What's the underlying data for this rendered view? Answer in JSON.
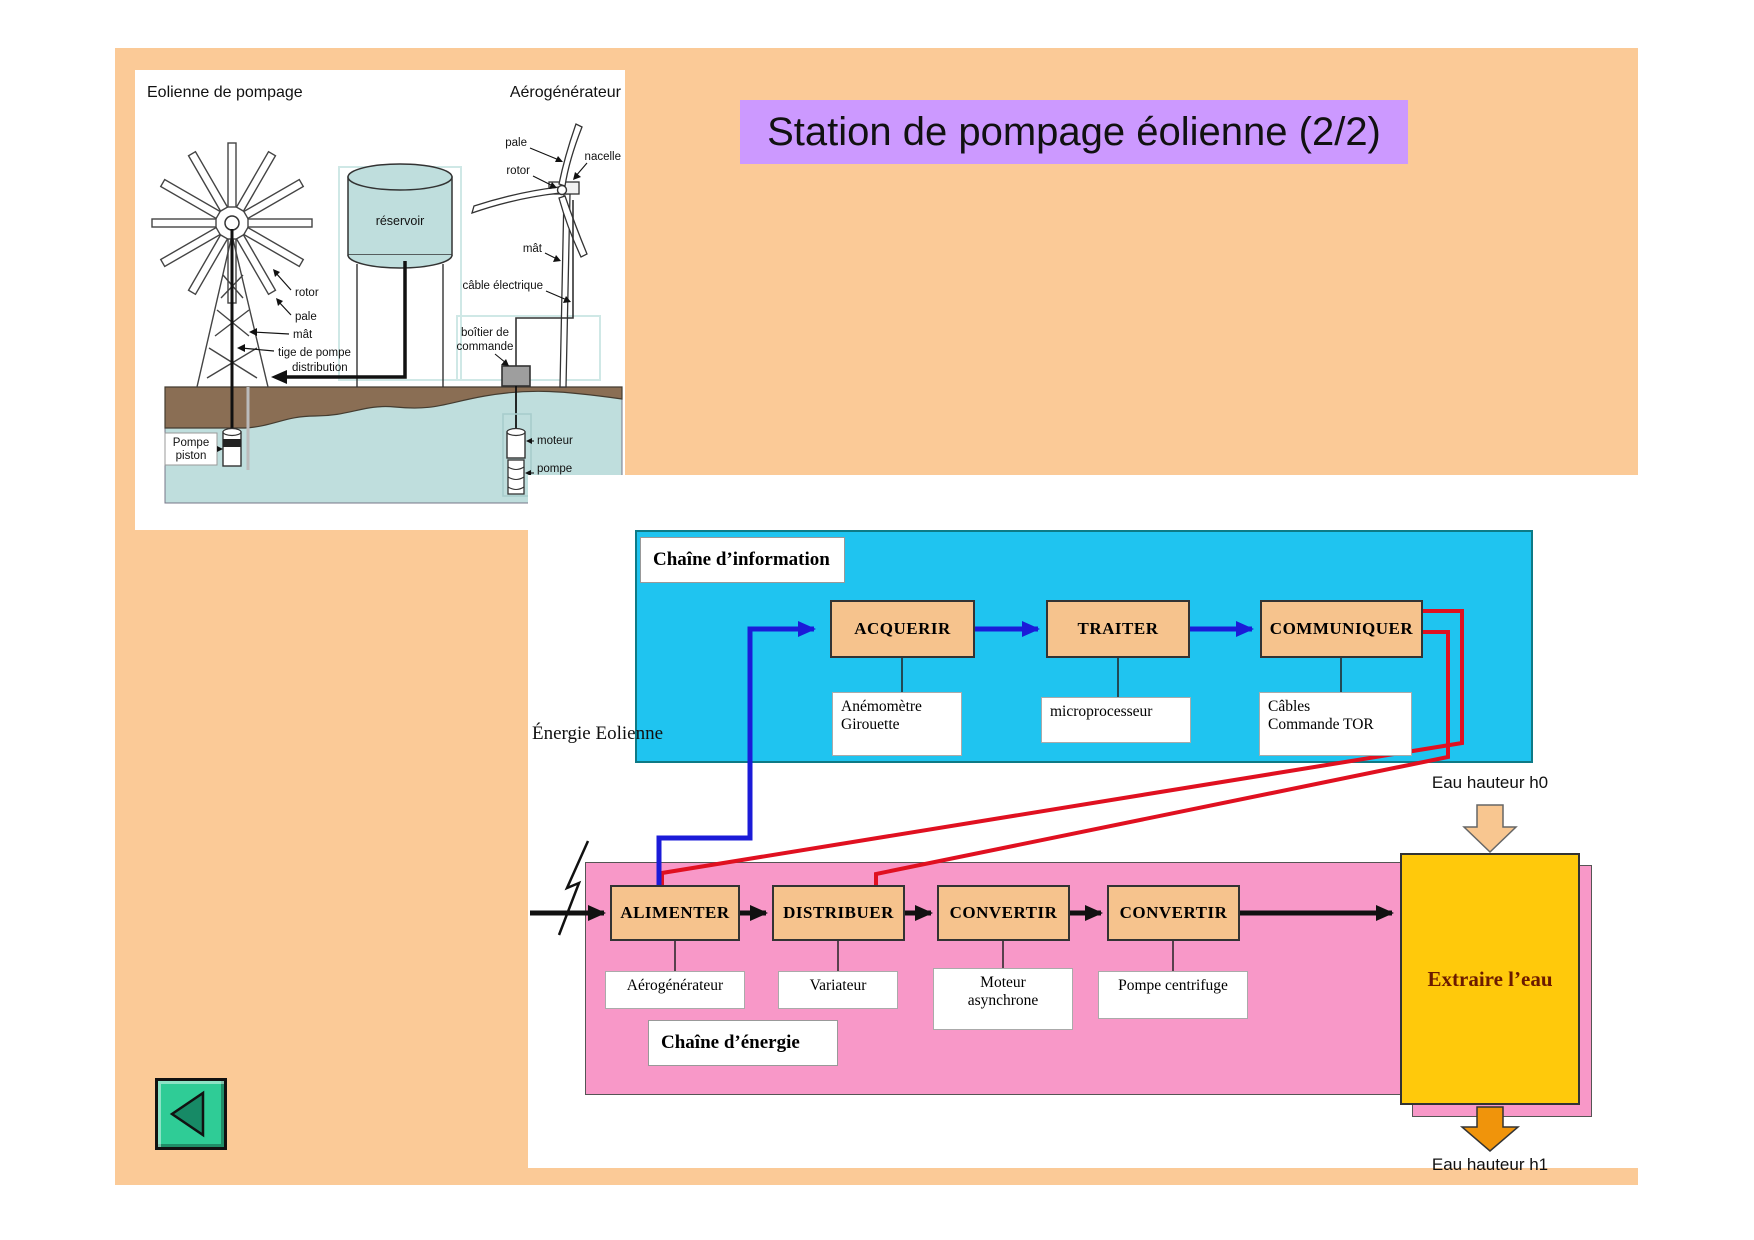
{
  "title": "Station de pompage éolienne (2/2)",
  "figure": {
    "caption_left": "Eolienne de pompage",
    "caption_right": "Aérogénérateur",
    "reservoir": "réservoir",
    "pump_rotor": "rotor",
    "pump_pale": "pale",
    "pump_mat": "mât",
    "pump_tige": "tige de pompe",
    "pump_distribution": "distribution",
    "pump_piston_l1": "Pompe",
    "pump_piston_l2": "piston",
    "aero_pale": "pale",
    "aero_rotor": "rotor",
    "aero_nacelle": "nacelle",
    "aero_mat": "mât",
    "aero_cable": "câble électrique",
    "aero_boitier_l1": "boîtier de",
    "aero_boitier_l2": "commande",
    "aero_moteur": "moteur",
    "aero_pompe_l1": "pompe",
    "aero_pompe_l2": "centrifuge"
  },
  "diagram": {
    "info_chain": {
      "title": "Chaîne d’information",
      "boxes": [
        "ACQUERIR",
        "TRAITER",
        "COMMUNIQUER"
      ],
      "components": [
        "Anémomètre\nGirouette",
        "microprocesseur",
        "Câbles\nCommande TOR"
      ]
    },
    "energy_chain": {
      "title": "Chaîne d’énergie",
      "input_label": "Énergie Eolienne",
      "boxes": [
        "ALIMENTER",
        "DISTRIBUER",
        "CONVERTIR",
        "CONVERTIR"
      ],
      "components": [
        "Aérogénérateur",
        "Variateur",
        "Moteur\nasynchrone",
        "Pompe centrifuge"
      ],
      "output_box": "Extraire l’eau"
    },
    "water_input": "Eau hauteur h0",
    "water_output": "Eau hauteur h1"
  },
  "colors": {
    "background": "#fbca97",
    "title_bar": "#cc99ff",
    "info_panel": "#1fc4f0",
    "energy_panel": "#f898c8",
    "process_box": "#f6c38d",
    "output_box": "#ffc90b",
    "signal_line": "#1b1bd8",
    "command_line": "#e01020",
    "back_button": "#2fcc96"
  }
}
